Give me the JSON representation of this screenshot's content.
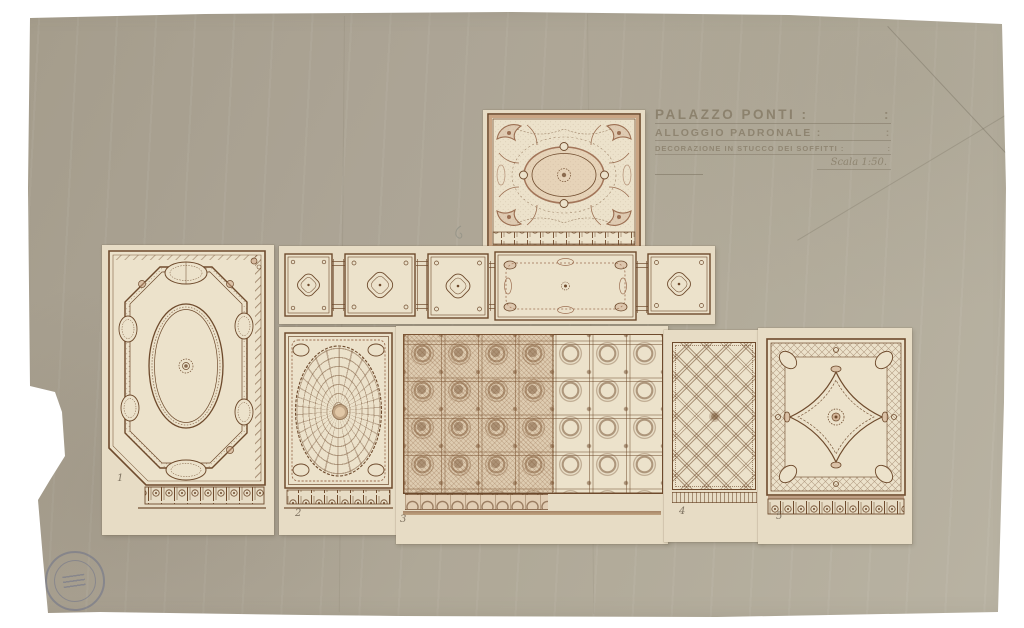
{
  "sheet": {
    "title_block": {
      "lines": [
        {
          "text": "PALAZZO PONTI :",
          "tail": ":"
        },
        {
          "text": "ALLOGGIO PADRONALE :",
          "tail": ":"
        },
        {
          "text": "DECORAZIONE IN STUCCO DEI SOFFITTI :",
          "tail": ":"
        }
      ],
      "scale_label": "Scala 1:50."
    },
    "panel_numbers": {
      "n1": "1",
      "n2": "2",
      "n3": "3",
      "n4": "4",
      "n5": "5"
    },
    "stamp": {
      "name": "circular-archive-stamp"
    },
    "colors": {
      "paper": "#ada695",
      "mount_paper": "#e7dcc5",
      "drawing_paper": "#ece2cb",
      "sepia_ink": "#6e4a2c",
      "pink_wash": "#d8b090",
      "tan_band": "#c49a78",
      "pencil": "#847964",
      "stamp_blue": "#5862a8"
    }
  }
}
